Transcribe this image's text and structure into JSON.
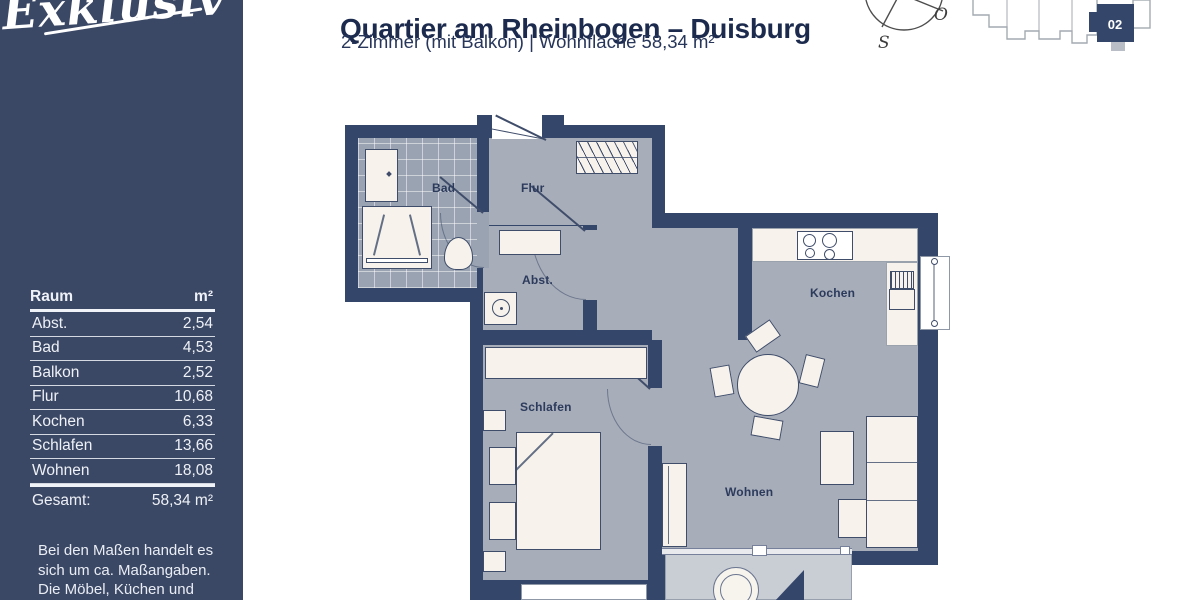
{
  "brand": {
    "logo_text": "Exklusiv",
    "registered": "®"
  },
  "header": {
    "title": "Quartier am Rheinbogen – Duisburg",
    "subtitle": "2-Zimmer (mit Balkon) | Wohnfläche 58,34 m²"
  },
  "compass": {
    "east_label": "O",
    "south_label": "S"
  },
  "site_plan": {
    "unit_label": "02"
  },
  "sidebar": {
    "table": {
      "header": {
        "room": "Raum",
        "area": "m²"
      },
      "rows": [
        {
          "room": "Abst.",
          "area": "2,54"
        },
        {
          "room": "Bad",
          "area": "4,53"
        },
        {
          "room": "Balkon",
          "area": "2,52"
        },
        {
          "room": "Flur",
          "area": "10,68"
        },
        {
          "room": "Kochen",
          "area": "6,33"
        },
        {
          "room": "Schlafen",
          "area": "13,66"
        },
        {
          "room": "Wohnen",
          "area": "18,08"
        }
      ],
      "total": {
        "label": "Gesamt:",
        "value": "58,34 m²"
      }
    },
    "disclaimer": {
      "line1": "Bei den Maßen handelt es",
      "line2": "sich um ca. Maßangaben.",
      "line3": "Die Möbel, Küchen und",
      "line4": "Sanitärobjekte sind"
    }
  },
  "floorplan": {
    "labels": {
      "bad": "Bad",
      "flur": "Flur",
      "abst": "Abst.",
      "kochen": "Kochen",
      "schlafen": "Schlafen",
      "wohnen": "Wohnen"
    }
  },
  "colors": {
    "navy_walls": "#35466b",
    "sidebar": "#3b4865",
    "floor_gray": "#a7adb9",
    "bath_tile": "#9aa3b1",
    "balcony_gray": "#c9cdd4",
    "furniture": "#f7f3ec",
    "title_text": "#1b2a4d"
  }
}
